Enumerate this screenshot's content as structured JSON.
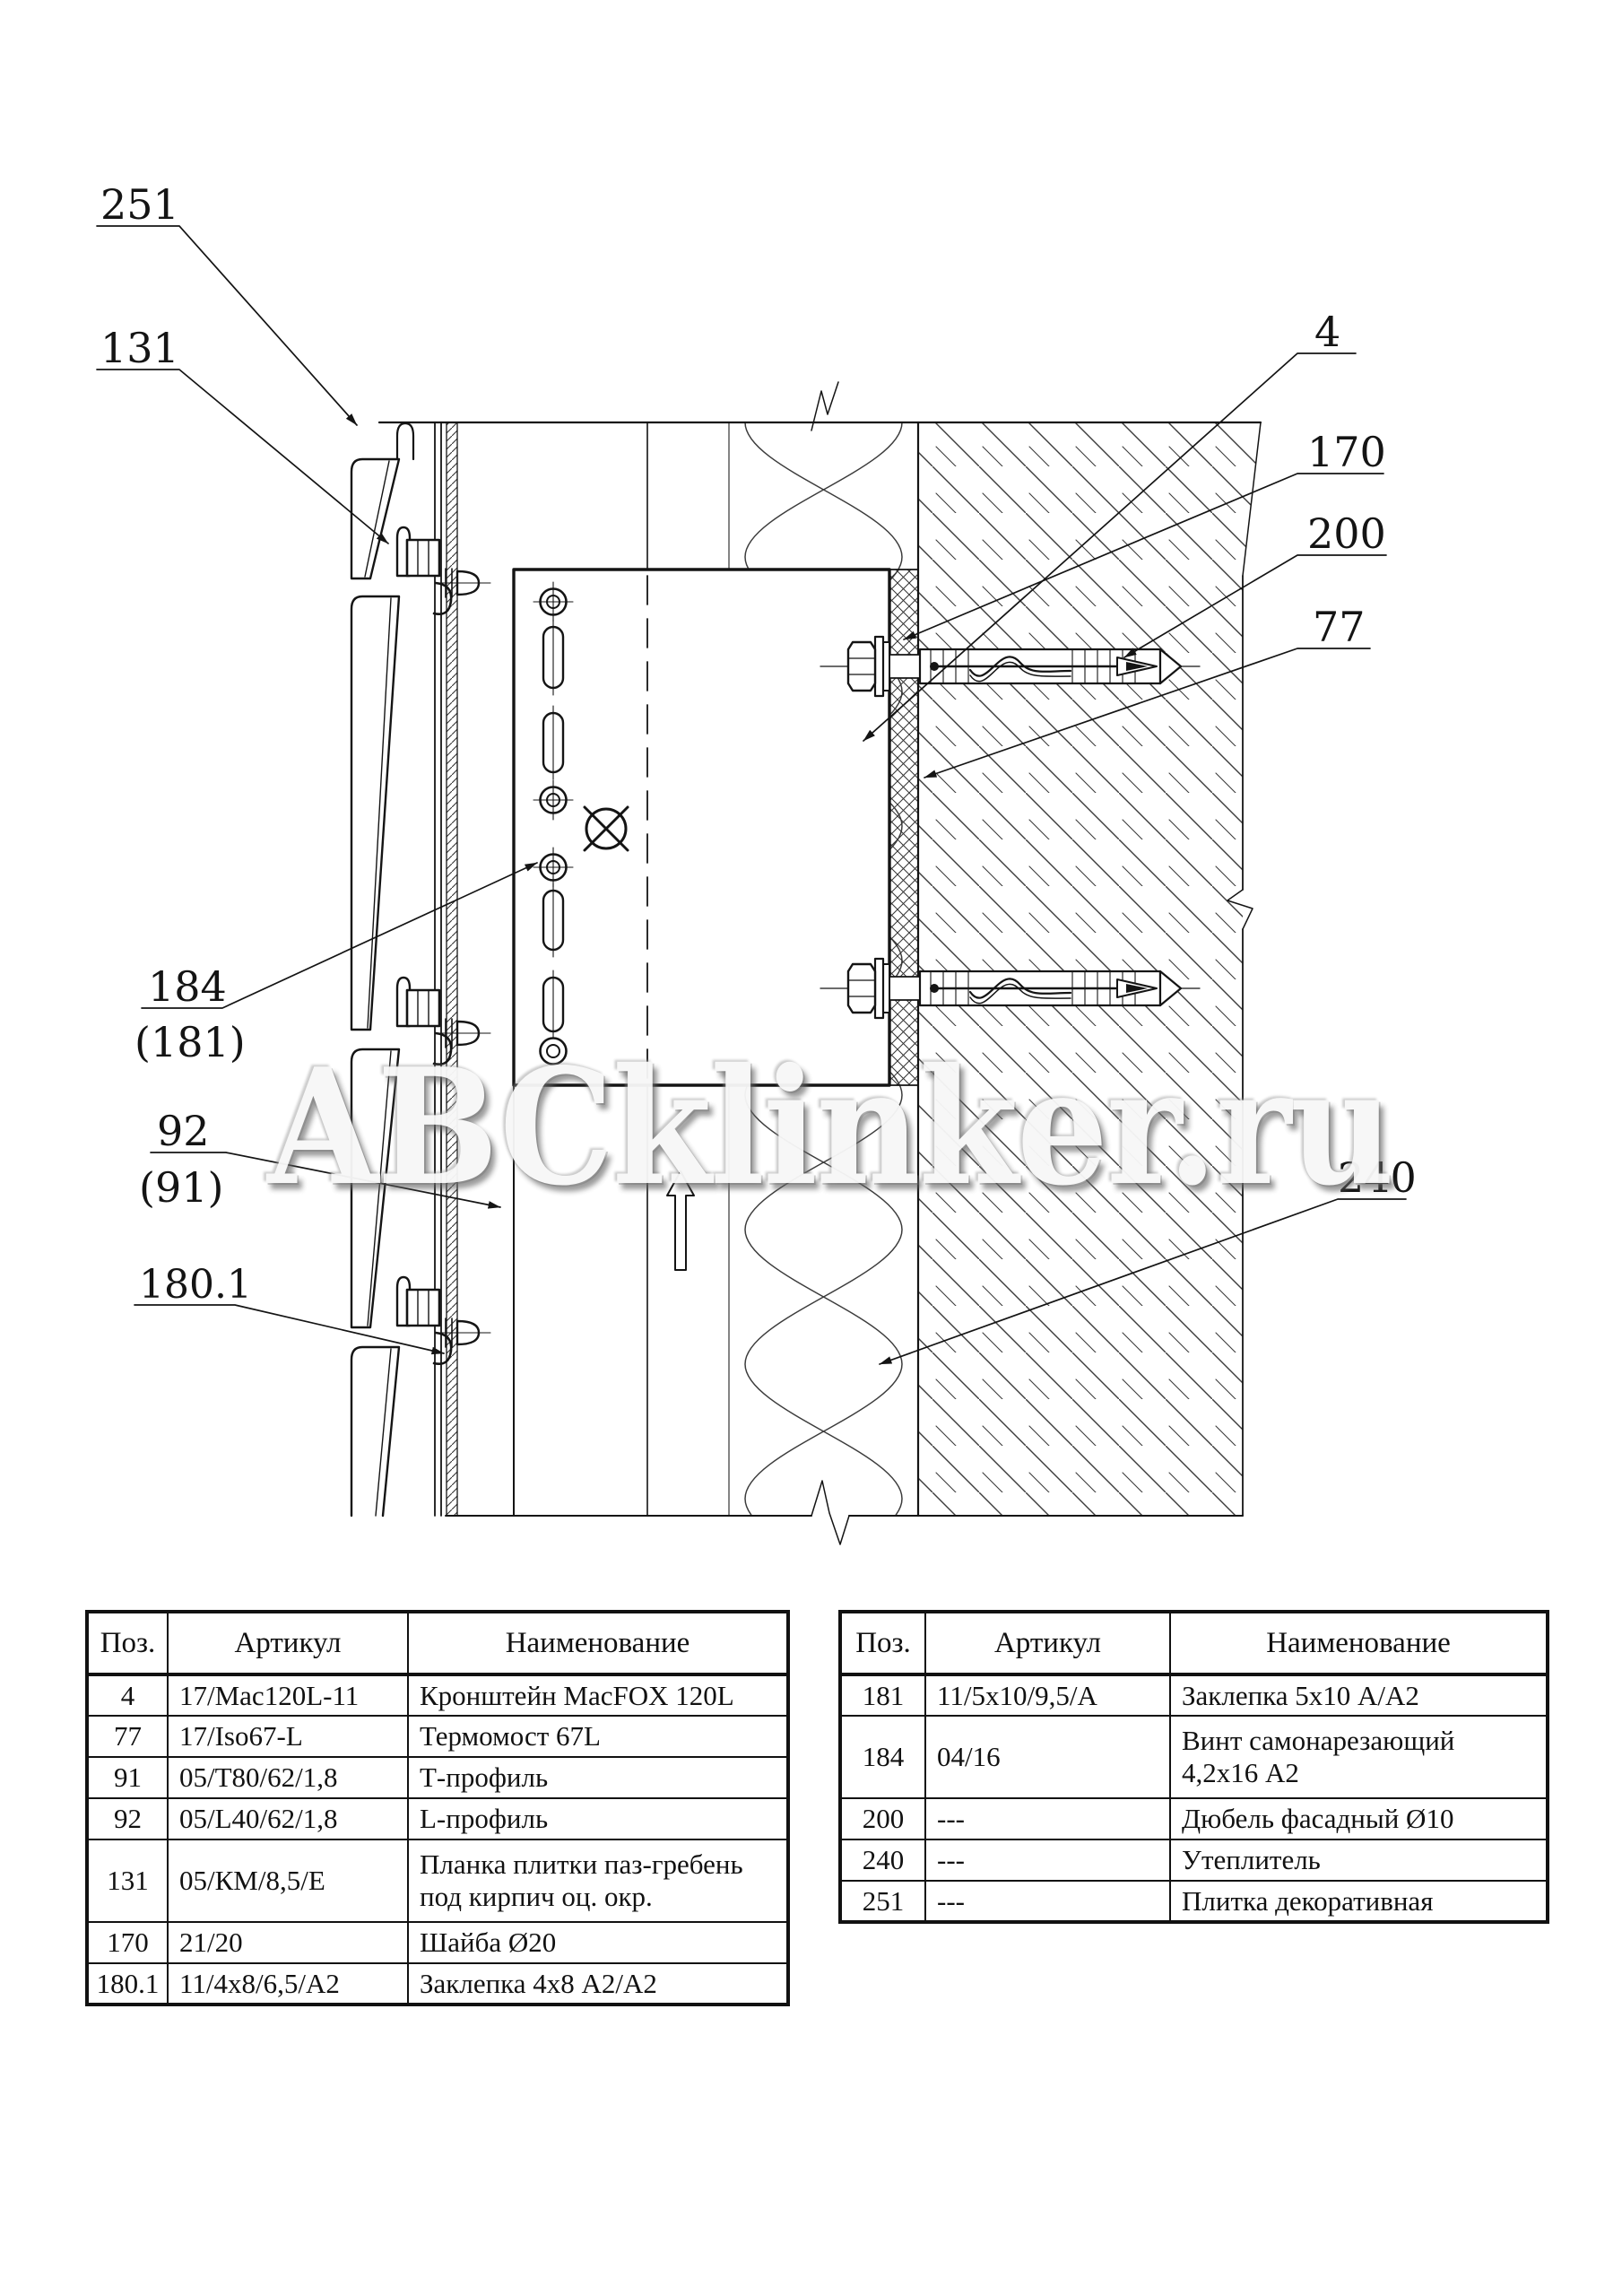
{
  "watermark": {
    "text": "ABCklinker.ru"
  },
  "drawing": {
    "callouts": {
      "c251": "251",
      "c131": "131",
      "c184": "184",
      "c181p": "(181)",
      "c92": "92",
      "c91p": "(91)",
      "c1801": "180.1",
      "c4": "4",
      "c170": "170",
      "c200": "200",
      "c77": "77",
      "c240": "240"
    }
  },
  "tables": {
    "headers": {
      "pos": "Поз.",
      "art": "Артикул",
      "name": "Наименование"
    },
    "left": {
      "rows": [
        {
          "pos": "4",
          "art": "17/Mac120L-11",
          "name": "Кронштейн MacFOX 120L"
        },
        {
          "pos": "77",
          "art": "17/Iso67-L",
          "name": "Термомост 67L"
        },
        {
          "pos": "91",
          "art": "05/Т80/62/1,8",
          "name": "Т-профиль"
        },
        {
          "pos": "92",
          "art": "05/L40/62/1,8",
          "name": "L-профиль"
        },
        {
          "pos": "131",
          "art": "05/КМ/8,5/Е",
          "name": "Планка плитки паз-гребень под кирпич оц. окр."
        },
        {
          "pos": "170",
          "art": "21/20",
          "name": "Шайба Ø20"
        },
        {
          "pos": "180.1",
          "art": "11/4х8/6,5/А2",
          "name": "Заклепка 4х8 А2/А2"
        }
      ]
    },
    "right": {
      "rows": [
        {
          "pos": "181",
          "art": "11/5х10/9,5/А",
          "name": "Заклепка 5х10 А/А2"
        },
        {
          "pos": "184",
          "art": "04/16",
          "name": "Винт самонарезающий 4,2х16 А2"
        },
        {
          "pos": "200",
          "art": "---",
          "name": "Дюбель фасадный Ø10"
        },
        {
          "pos": "240",
          "art": "---",
          "name": "Утеплитель"
        },
        {
          "pos": "251",
          "art": "---",
          "name": "Плитка декоративная"
        }
      ]
    }
  }
}
